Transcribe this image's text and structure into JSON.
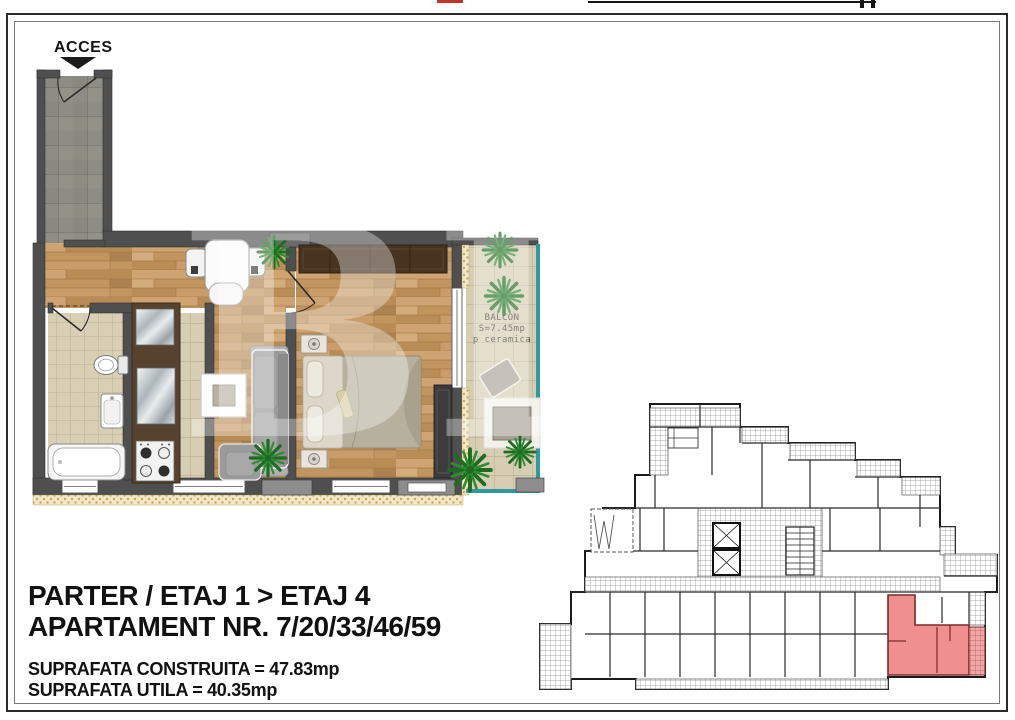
{
  "page": {
    "access_label": "ACCES",
    "watermark_text": "BL"
  },
  "balcony": {
    "name": "BALCON",
    "area": "S=7.45mp",
    "finish": "p  ceramica"
  },
  "info": {
    "floors": "PARTER / ETAJ 1 > ETAJ 4",
    "apartment_number": "APARTAMENT NR. 7/20/33/46/59",
    "built_area": "SUPRAFATA CONSTRUITA = 47.83mp",
    "usable_area": "SUPRAFATA UTILA = 40.35mp"
  },
  "colors": {
    "wall": "#4f4f4f",
    "wood_floor": "#c49663",
    "tile_beige": "#d8cfb5",
    "tile_gray": "#8d8d83",
    "glass_teal": "#2e9aa0",
    "highlight_red": "#ef8585",
    "plant_green": "#2f8c33"
  }
}
